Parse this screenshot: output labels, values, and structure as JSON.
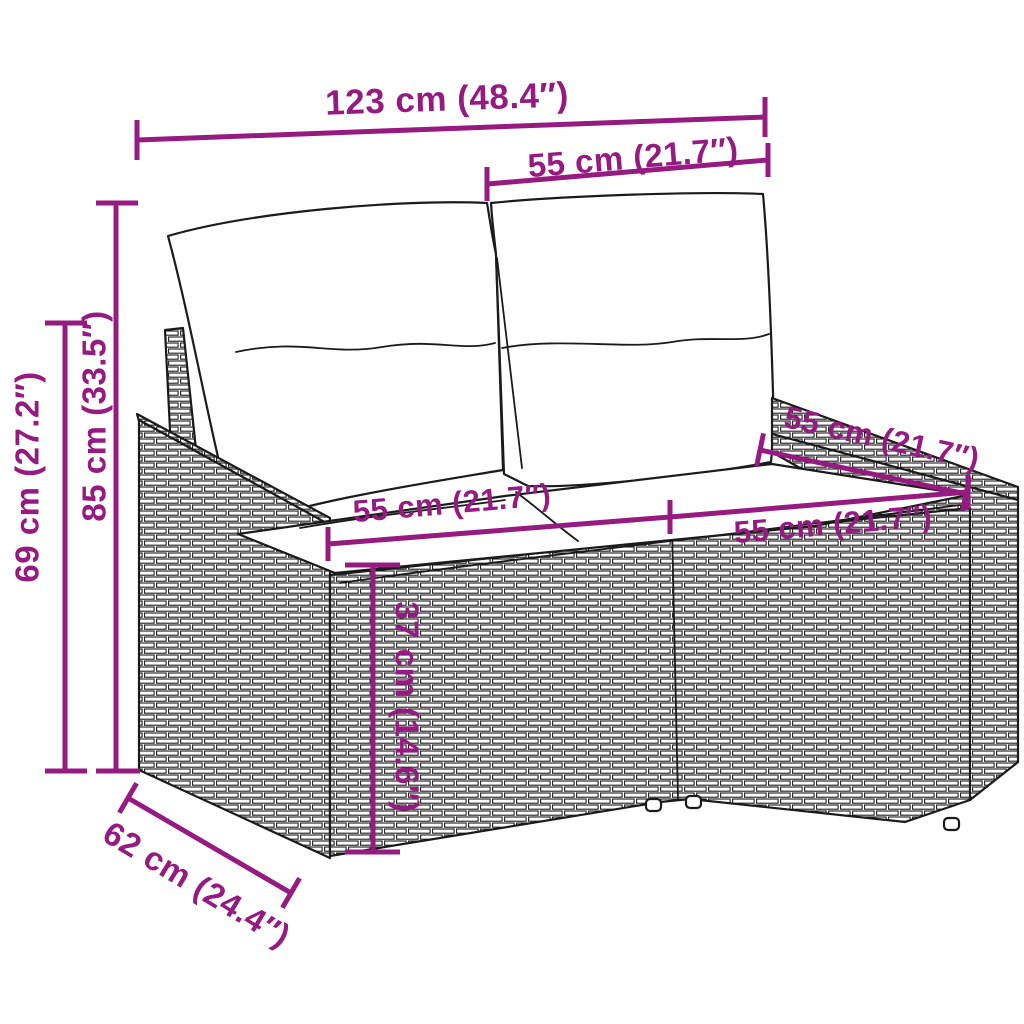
{
  "diagram": {
    "name": "rattan-garden-loveseat-dimension-diagram",
    "product": "poly rattan 2-seater garden sofa with cushions",
    "background_color": "#ffffff",
    "accent_color": "#951B81",
    "line_art_color": "#1b1b1b",
    "measurements": [
      {
        "name": "overall-width",
        "label": "123 cm (48.4″)",
        "cm": 123,
        "inches": 48.4,
        "orientation": "horizontal"
      },
      {
        "name": "backrest-section-width",
        "label": "55 cm (21.7″)",
        "cm": 55,
        "inches": 21.7,
        "orientation": "horizontal"
      },
      {
        "name": "overall-height",
        "label": "85 cm (33.5″)",
        "cm": 85,
        "inches": 33.5,
        "orientation": "vertical"
      },
      {
        "name": "armrest-height",
        "label": "69 cm (27.2″)",
        "cm": 69,
        "inches": 27.2,
        "orientation": "vertical"
      },
      {
        "name": "seat-width-left",
        "label": "55 cm (21.7″)",
        "cm": 55,
        "inches": 21.7,
        "orientation": "horizontal"
      },
      {
        "name": "seat-width-right",
        "label": "55 cm (21.7″)",
        "cm": 55,
        "inches": 21.7,
        "orientation": "horizontal"
      },
      {
        "name": "seat-depth",
        "label": "55 cm (21.7″)",
        "cm": 55,
        "inches": 21.7,
        "orientation": "diagonal"
      },
      {
        "name": "seat-height",
        "label": "37 cm (14.6″)",
        "cm": 37,
        "inches": 14.6,
        "orientation": "vertical"
      },
      {
        "name": "overall-depth",
        "label": "62 cm (24.4″)",
        "cm": 62,
        "inches": 24.4,
        "orientation": "diagonal"
      }
    ]
  }
}
